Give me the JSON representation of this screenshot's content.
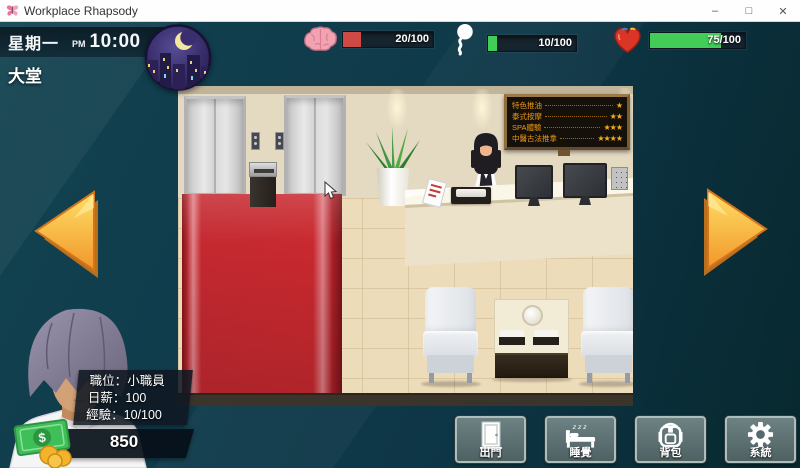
{
  "window": {
    "title": "Workplace Rhapsody",
    "app_icon": "butterfly-icon",
    "controls": {
      "minimize": "–",
      "maximize": "□",
      "close": "✕"
    }
  },
  "hud": {
    "day": "星期一",
    "meridiem": "PM",
    "time": "10:00",
    "location": "大堂",
    "moon_icon": "crescent-moon-night-city",
    "stats": [
      {
        "name": "energy",
        "icon": "brain-icon",
        "value": "20/100",
        "percent": 20,
        "color": "#cf4a45"
      },
      {
        "name": "mood",
        "icon": "thought-bubble-icon",
        "value": "10/100",
        "percent": 10,
        "color": "#41cd58"
      },
      {
        "name": "health",
        "icon": "heart-icon",
        "value": "75/100",
        "percent": 75,
        "color": "#41cd58"
      }
    ]
  },
  "scene": {
    "name": "lobby",
    "menu_board": {
      "items": [
        {
          "label": "特色推油",
          "stars": "★"
        },
        {
          "label": "泰式按摩",
          "stars": "★★"
        },
        {
          "label": "SPA體驗",
          "stars": "★★★"
        },
        {
          "label": "中醫古法推拿",
          "stars": "★★★★"
        }
      ]
    }
  },
  "character": {
    "info": [
      {
        "label": "職位：",
        "value": "小職員"
      },
      {
        "label": "日薪：",
        "value": "100"
      },
      {
        "label": "經驗：",
        "value": "10/100"
      }
    ],
    "money": "850",
    "money_icon": "cash-coins-icon"
  },
  "actions": [
    {
      "label": "出門",
      "icon": "door-icon"
    },
    {
      "label": "睡覺",
      "icon": "bed-icon"
    },
    {
      "label": "背包",
      "icon": "backpack-icon"
    },
    {
      "label": "系統",
      "icon": "gear-icon"
    }
  ],
  "colors": {
    "background": "#0e3847",
    "arrow_gold": "#f6a42c",
    "menu_text": "#ef9915"
  }
}
